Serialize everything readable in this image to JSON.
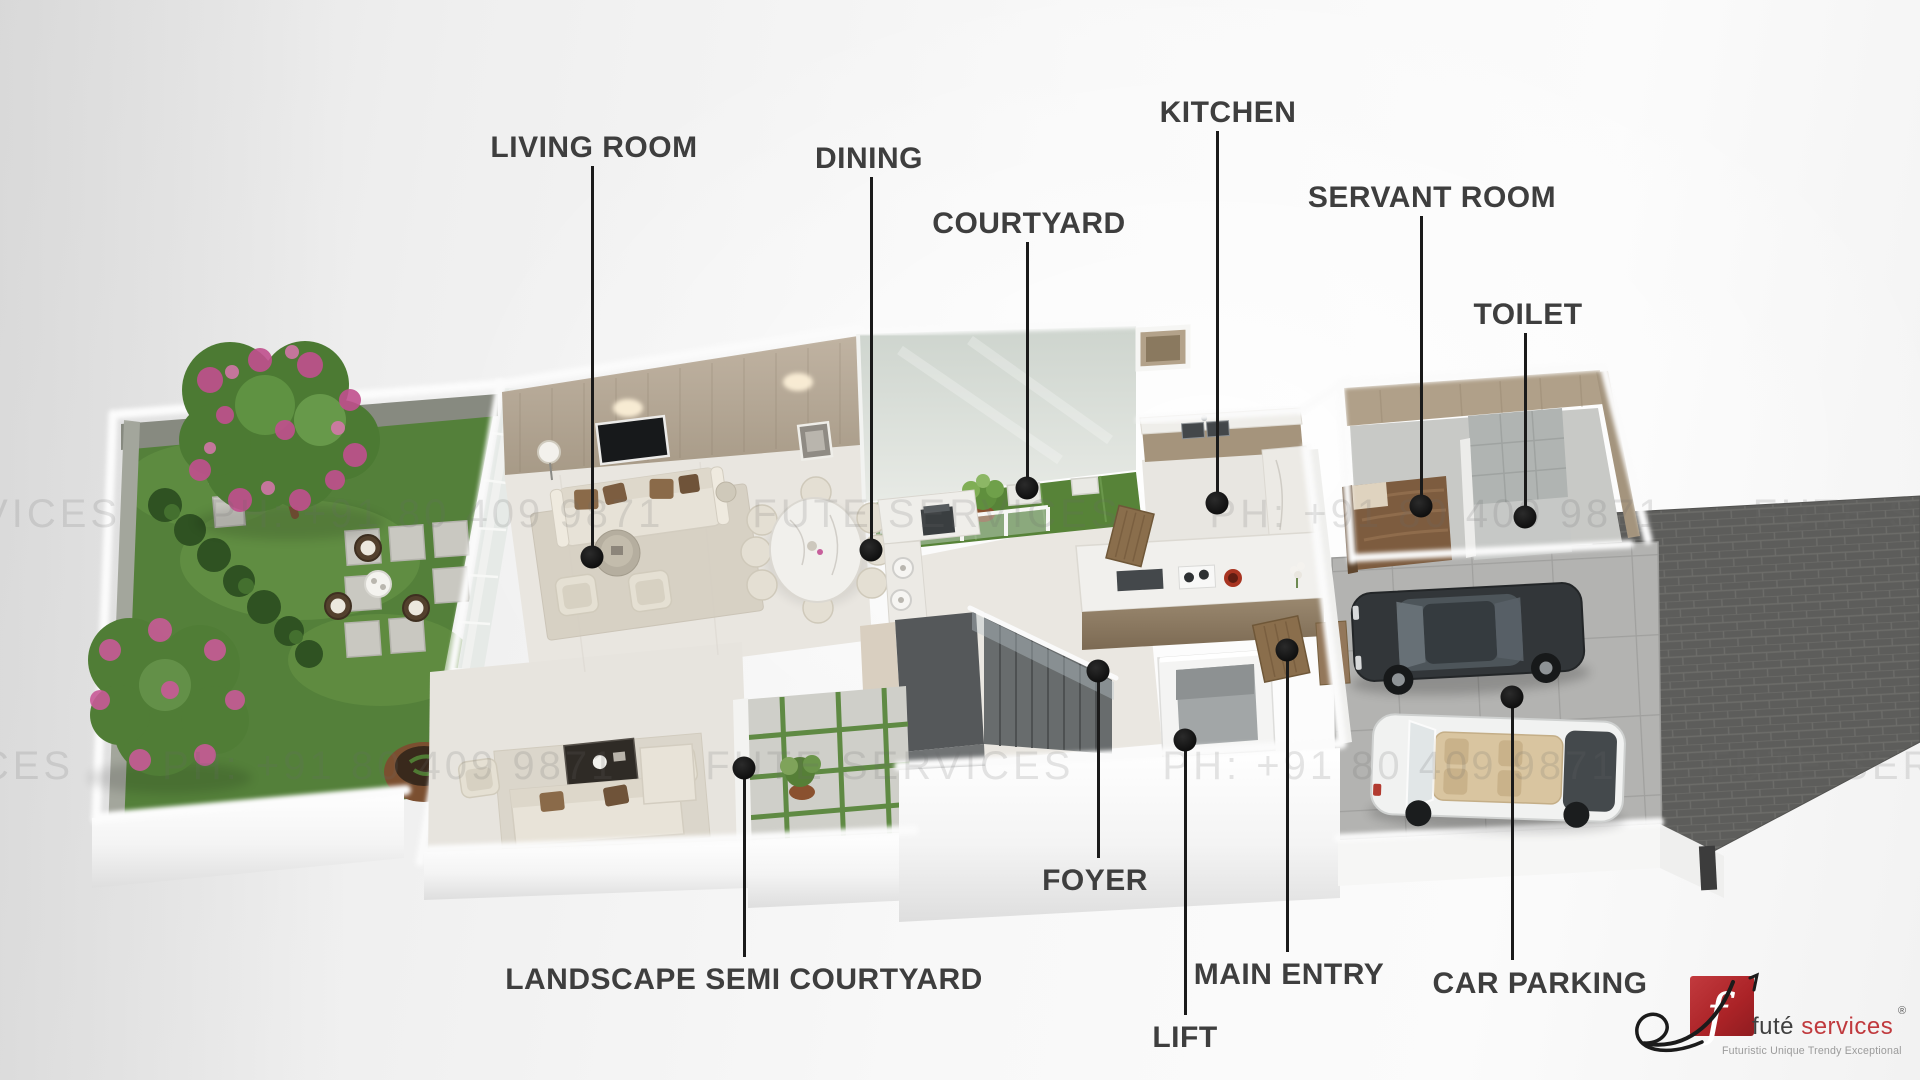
{
  "scene": {
    "description": "3D isometric rendered ground-floor plan of a row house with landscaped garden, living, dining, courtyard, kitchen, servant room, toilet, foyer, lift, stairs and double car parking"
  },
  "annotations": [
    {
      "id": "living-room",
      "text": "LIVING ROOM"
    },
    {
      "id": "dining",
      "text": "DINING"
    },
    {
      "id": "courtyard",
      "text": "COURTYARD"
    },
    {
      "id": "kitchen",
      "text": "KITCHEN"
    },
    {
      "id": "servant-room",
      "text": "SERVANT ROOM"
    },
    {
      "id": "toilet",
      "text": "TOILET"
    },
    {
      "id": "landscape-semi-courtyard",
      "text": "LANDSCAPE SEMI COURTYARD"
    },
    {
      "id": "foyer",
      "text": "FOYER"
    },
    {
      "id": "lift",
      "text": "LIFT"
    },
    {
      "id": "main-entry",
      "text": "MAIN ENTRY"
    },
    {
      "id": "car-parking",
      "text": "CAR PARKING"
    }
  ],
  "watermark": {
    "company": "FUTE SERVICES",
    "phone": "PH: +91 80 409 9871",
    "line": "FUTE SERVICES  PH: +91 80 409 9871  FUTE SERVICES  PH: +91 80 409 9871  FUTE SERVICES  PH: +91 80 409 9871"
  },
  "logo": {
    "monogram": "f",
    "name": "futé",
    "name_suffix": "services",
    "registered": "®",
    "tagline": "Futuristic Unique Trendy Exceptional"
  },
  "palette": {
    "label-color": "#3e3e3e",
    "line-color": "#1a1a1a",
    "watermark-color": "#6a6a6a",
    "logo-red": "#b5282c",
    "logo-name-color": "#3f3f3f",
    "logo-suffix-color": "#c0393d",
    "logo-tagline-color": "#9b9b9b",
    "lawn-green": "#54803a",
    "courtyard-grass": "#578338",
    "wood-wall": "#b5a897",
    "floor-beige": "#e9e6e0",
    "wall-white": "#fbfbfb",
    "driveway-brick": "#5d5d5b",
    "parking-pad": "#b3b3b1"
  }
}
